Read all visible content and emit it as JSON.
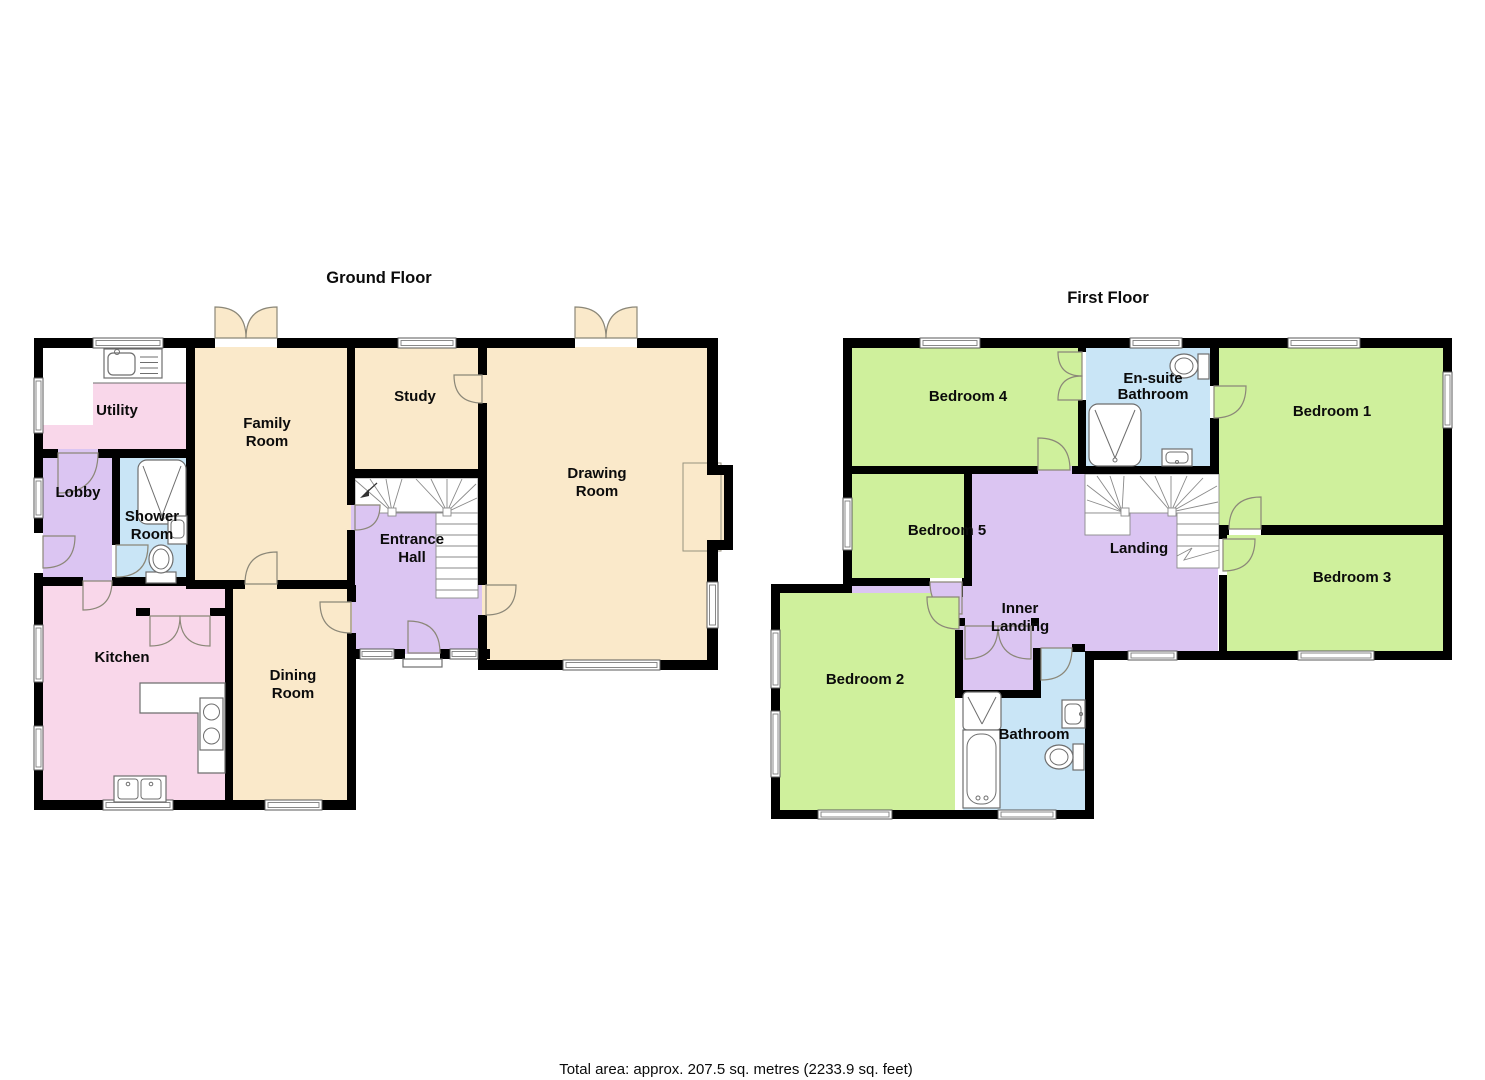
{
  "palette": {
    "wall": "#000000",
    "cream_room": "#FAE9CA",
    "pink_room": "#F9D7EA",
    "purple_hall": "#DBC5F2",
    "blue_bathroom": "#C9E5F6",
    "green_bedroom": "#CFF09C",
    "window_frame": "#5a5a5a",
    "door_stroke": "#8B8778"
  },
  "footer": {
    "total_area": "Total area: approx. 207.5 sq. metres (2233.9 sq. feet)"
  },
  "ground_floor": {
    "title": "Ground Floor",
    "rooms": {
      "utility": "Utility",
      "lobby": "Lobby",
      "shower_room": {
        "line1": "Shower",
        "line2": "Room"
      },
      "family_room": {
        "line1": "Family",
        "line2": "Room"
      },
      "study": "Study",
      "drawing_room": {
        "line1": "Drawing",
        "line2": "Room"
      },
      "entrance_hall": {
        "line1": "Entrance",
        "line2": "Hall"
      },
      "kitchen": "Kitchen",
      "dining_room": {
        "line1": "Dining",
        "line2": "Room"
      }
    }
  },
  "first_floor": {
    "title": "First Floor",
    "rooms": {
      "bedroom_4": "Bedroom 4",
      "ensuite_bathroom": {
        "line1": "En-suite",
        "line2": "Bathroom"
      },
      "bedroom_1": "Bedroom 1",
      "bedroom_5": "Bedroom 5",
      "landing": "Landing",
      "bedroom_3": "Bedroom 3",
      "inner_landing": {
        "line1": "Inner",
        "line2": "Landing"
      },
      "bedroom_2": "Bedroom 2",
      "bathroom": "Bathroom"
    }
  }
}
